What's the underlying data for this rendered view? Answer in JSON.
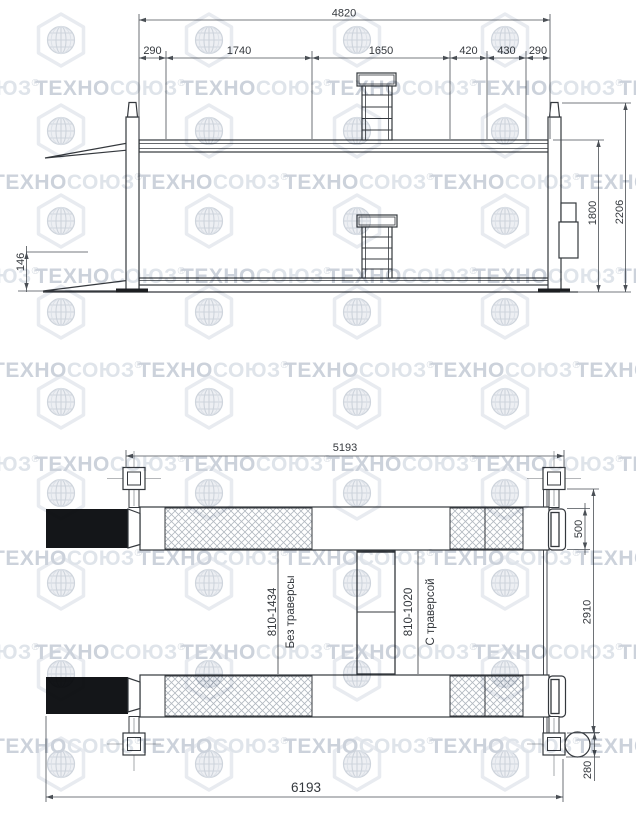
{
  "watermark": {
    "brand_main": "ТЕХНО",
    "brand_tail": "СОЮЗ",
    "registered": "®"
  },
  "side_view": {
    "dim_overall_top": "4820",
    "segments": [
      "290",
      "1740",
      "1650",
      "420",
      "430",
      "290"
    ],
    "dim_total_height": "2206",
    "dim_lift_height": "1800",
    "dim_platform_height": "146"
  },
  "plan_view": {
    "dim_post_span": "5193",
    "dim_runway_width": "500",
    "dim_track_width": "2910",
    "dim_cylinder": "280",
    "dim_overall_length": "6193",
    "label_no_traverse_range": "810-1434",
    "label_no_traverse": "Без траверсы",
    "label_traverse_range": "810-1020",
    "label_traverse": "С траверсой"
  }
}
